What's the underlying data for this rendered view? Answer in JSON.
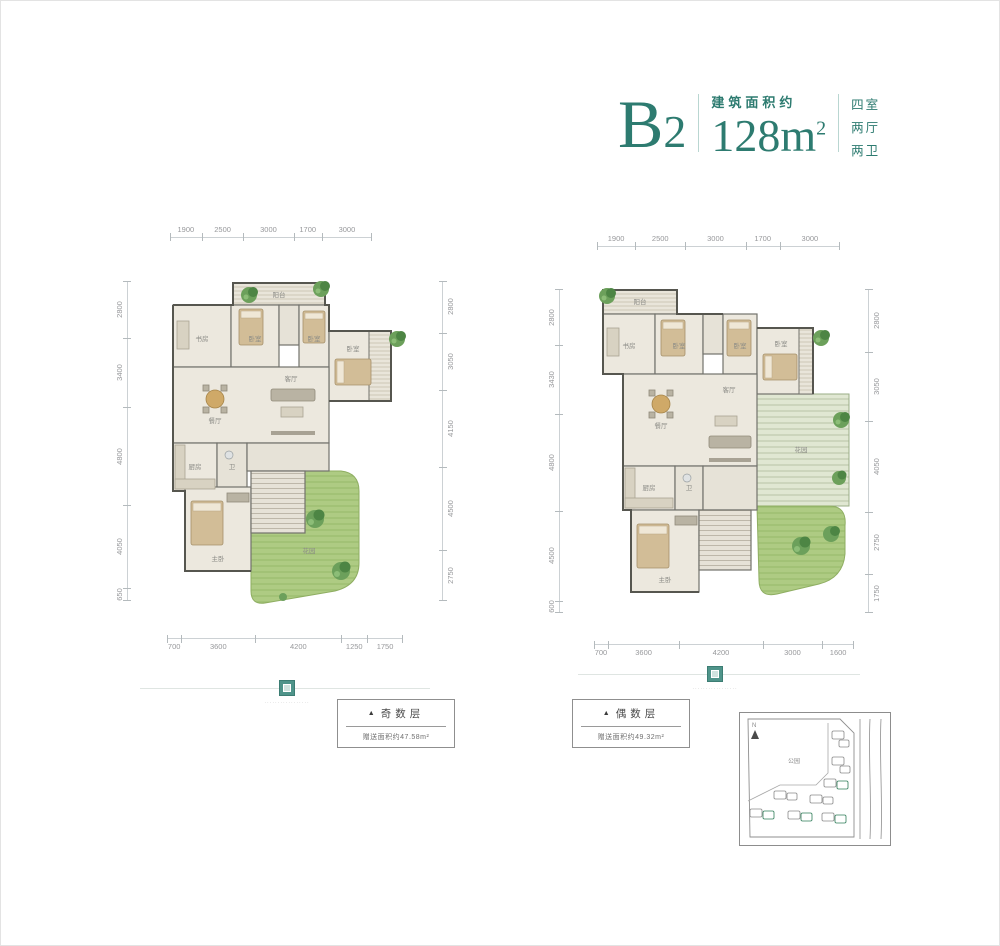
{
  "header": {
    "unit_letter": "B",
    "unit_digit": "2",
    "area_label": "建筑面积约",
    "area_value": "128m",
    "area_sup": "2",
    "room_info": [
      "四室",
      "两厅",
      "两卫"
    ]
  },
  "plans": [
    {
      "tag_marker": "▲",
      "tag": "奇数层",
      "bonus": "赠送面积约47.58m²",
      "caption": "·················",
      "dims": {
        "top": [
          "1900",
          "2500",
          "3000",
          "1700",
          "3000"
        ],
        "left": [
          "2800",
          "3400",
          "4800",
          "4050",
          "650"
        ],
        "right": [
          "2800",
          "3050",
          "4150",
          "4500",
          "2750"
        ],
        "bottom": [
          "700",
          "3600",
          "4200",
          "1250",
          "1750"
        ]
      },
      "room_labels": [
        "阳台",
        "书房",
        "卧室",
        "卧室",
        "卧室",
        "餐厅",
        "客厅",
        "厨房",
        "卫",
        "主卧",
        "花园"
      ]
    },
    {
      "tag_marker": "▲",
      "tag": "偶数层",
      "bonus": "赠送面积约49.32m²",
      "caption": "·················",
      "dims": {
        "top": [
          "1900",
          "2500",
          "3000",
          "1700",
          "3000"
        ],
        "left": [
          "2800",
          "3430",
          "4800",
          "4500",
          "600"
        ],
        "right": [
          "2800",
          "3050",
          "4050",
          "2750",
          "1750"
        ],
        "bottom": [
          "700",
          "3600",
          "4200",
          "3000",
          "1600"
        ]
      },
      "room_labels": [
        "阳台",
        "书房",
        "卧室",
        "卧室",
        "卧室",
        "餐厅",
        "客厅",
        "厨房",
        "卫",
        "主卧",
        "花园"
      ]
    }
  ],
  "siteplan": {
    "north_label": "N",
    "park_label": "公园"
  },
  "colors": {
    "accent": "#2d7b70",
    "dim_text": "#98999b",
    "lawn": "#a9c77e",
    "highlight_building": "#2f7d59"
  }
}
